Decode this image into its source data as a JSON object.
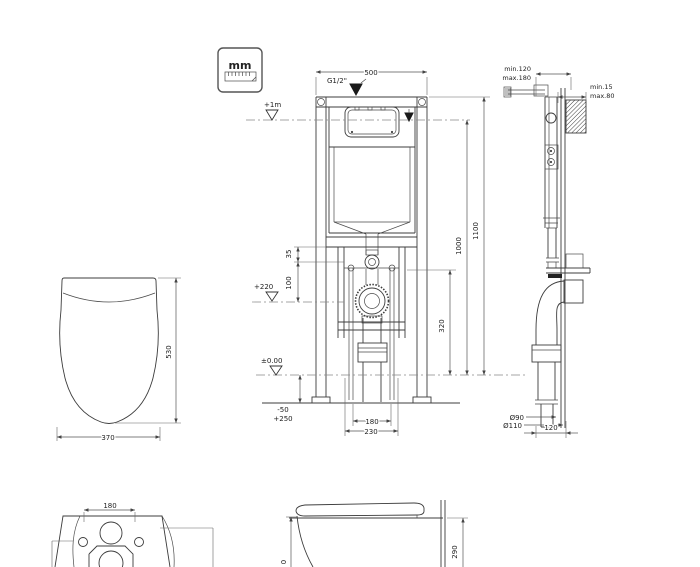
{
  "units_box": {
    "label": "mm"
  },
  "front_view": {
    "dim_width": "500",
    "water_connection": "G1/2\"",
    "level_plus1m": "+1m",
    "level_plus220": "+220",
    "level_zero": "±0.00",
    "dim_35": "35",
    "dim_100": "100",
    "dim_320": "320",
    "dim_1000": "1000",
    "dim_1100": "1100",
    "adjust_low": "-50",
    "adjust_high": "+250",
    "dim_bolt_spacing": "180",
    "dim_outlet_spacing": "230"
  },
  "side_view": {
    "frame_depth_min": "min.120",
    "frame_depth_max": "max.180",
    "panel_min": "min.15",
    "panel_max": "max.80",
    "drain_outer": "Ø90",
    "drain_pipe": "Ø110",
    "dim_pipe_offset": "120"
  },
  "pan_top_view": {
    "dim_length": "530",
    "dim_width": "370"
  },
  "pan_rear_view": {
    "dim_holes": "180"
  },
  "pan_side_view": {
    "dim_height": "290",
    "dim_partial": "0"
  }
}
